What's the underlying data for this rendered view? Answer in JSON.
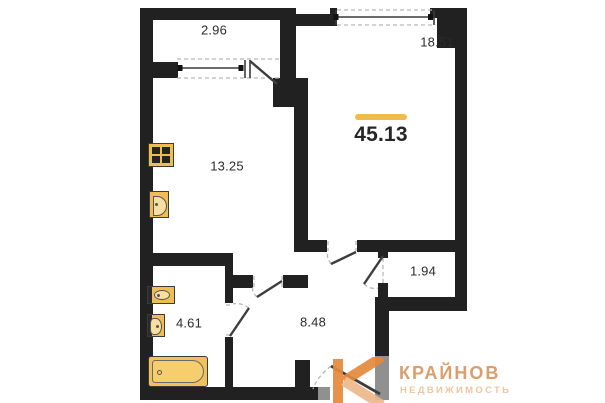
{
  "plan": {
    "total_area": "45.13",
    "rooms": {
      "balcony": {
        "area": "2.96"
      },
      "living": {
        "area": "18.51"
      },
      "kitchen": {
        "area": "13.25"
      },
      "storage": {
        "area": "1.94"
      },
      "bathroom": {
        "area": "4.61"
      },
      "hallway": {
        "area": "8.48"
      }
    },
    "fixtures": [
      "stove-icon",
      "kitchen-sink-icon",
      "washbasin-icon",
      "toilet-icon",
      "bathtub-icon"
    ],
    "colors": {
      "wall": "#212121",
      "accent": "#f2ba4a",
      "fixture_fill": "#f0bd55",
      "logo_mark": "#e5893b",
      "logo_text": "#db9e6c",
      "logo_tagline": "#ecc7a2"
    }
  },
  "watermark": {
    "brand": "КРАЙНОВ",
    "tagline": "НЕДВИЖИМОСТЬ"
  }
}
